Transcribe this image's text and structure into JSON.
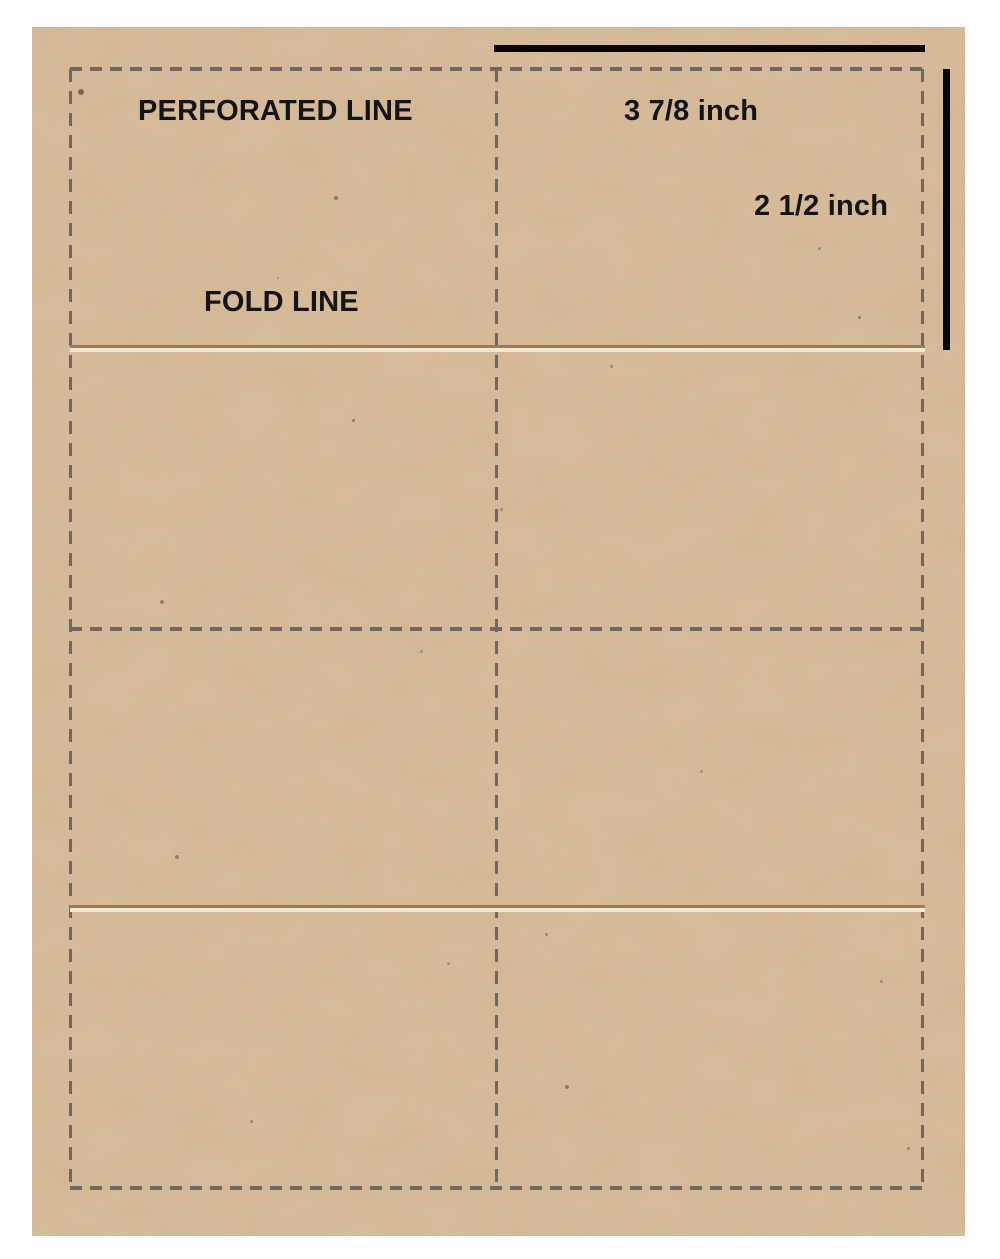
{
  "canvas": {
    "background": "#ffffff"
  },
  "sheet": {
    "material_color": "#d8bb99",
    "labels": {
      "perforated_line": "PERFORATED LINE",
      "fold_line": "FOLD LINE"
    },
    "measurements": {
      "cell_width": "3 7/8 inch",
      "cell_height": "2 1/2 inch"
    },
    "colors": {
      "perforation_dash": "#6d6863",
      "fold_crease_dark": "#9c7b58",
      "fold_crease_light": "#f4e7cf",
      "measurement_bar": "#070707",
      "label_text": "#141414"
    },
    "structure": {
      "columns": 2,
      "rows": 4,
      "horizontal_perforated_lines": 3,
      "vertical_perforated_lines": 3,
      "fold_lines": 2
    }
  }
}
